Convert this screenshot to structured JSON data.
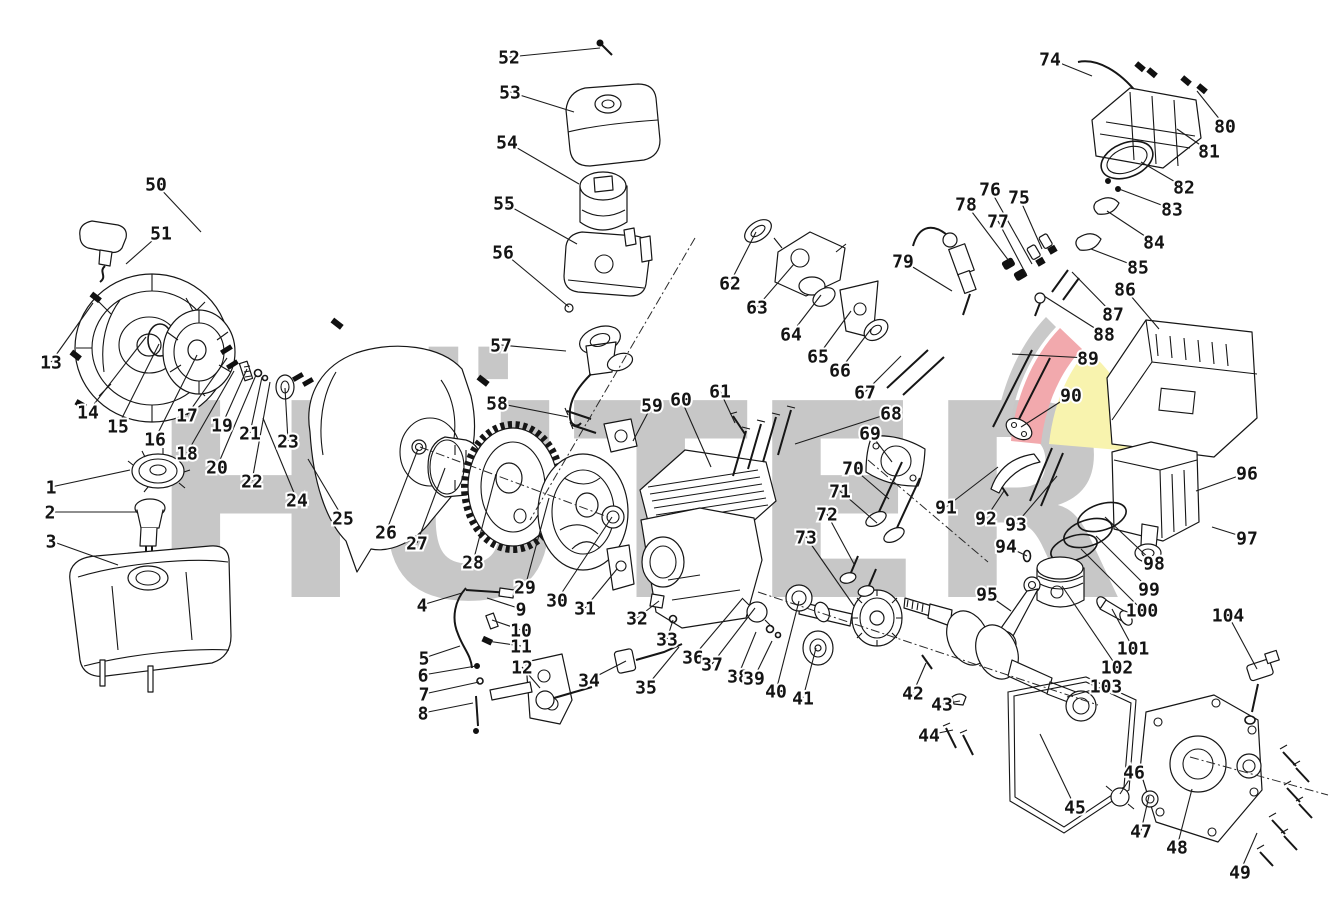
{
  "page": {
    "background_color": "#ffffff",
    "width": 1339,
    "height": 912
  },
  "watermark": {
    "text": "HÜTER",
    "color": "#c7c7c7",
    "logo_gray": "#c9c9c9",
    "logo_red": "#f2a9ad",
    "logo_yellow": "#f8f3ae"
  },
  "diagram": {
    "type": "exploded-parts-diagram",
    "subject": "small gasoline engine",
    "label_format": [
      "number",
      "x",
      "y",
      "target_x",
      "target_y"
    ],
    "labels": [
      [
        1,
        51,
        487,
        130,
        470
      ],
      [
        2,
        50,
        512,
        137,
        512
      ],
      [
        3,
        51,
        541,
        118,
        565
      ],
      [
        4,
        422,
        605,
        462,
        593
      ],
      [
        5,
        424,
        658,
        460,
        646
      ],
      [
        6,
        423,
        675,
        476,
        666
      ],
      [
        7,
        424,
        694,
        479,
        682
      ],
      [
        8,
        423,
        713,
        473,
        703
      ],
      [
        9,
        521,
        609,
        487,
        598
      ],
      [
        10,
        521,
        630,
        492,
        620
      ],
      [
        11,
        521,
        646,
        487,
        641
      ],
      [
        12,
        522,
        667,
        540,
        688
      ],
      [
        13,
        51,
        362,
        93,
        303
      ],
      [
        14,
        88,
        412,
        146,
        337
      ],
      [
        15,
        118,
        426,
        159,
        344
      ],
      [
        16,
        155,
        439,
        197,
        355
      ],
      [
        17,
        187,
        415,
        227,
        358
      ],
      [
        18,
        187,
        453,
        234,
        371
      ],
      [
        19,
        222,
        425,
        247,
        369
      ],
      [
        20,
        217,
        467,
        256,
        375
      ],
      [
        21,
        250,
        433,
        262,
        377
      ],
      [
        22,
        252,
        481,
        270,
        382
      ],
      [
        23,
        288,
        441,
        285,
        388
      ],
      [
        24,
        297,
        500,
        263,
        418
      ],
      [
        25,
        343,
        518,
        308,
        459
      ],
      [
        26,
        386,
        532,
        418,
        449
      ],
      [
        27,
        417,
        543,
        445,
        468
      ],
      [
        28,
        473,
        562,
        496,
        474
      ],
      [
        29,
        525,
        587,
        549,
        498
      ],
      [
        30,
        557,
        600,
        612,
        517
      ],
      [
        31,
        585,
        608,
        617,
        569
      ],
      [
        32,
        637,
        618,
        659,
        601
      ],
      [
        33,
        667,
        639,
        673,
        620
      ],
      [
        34,
        589,
        680,
        626,
        661
      ],
      [
        35,
        646,
        687,
        679,
        647
      ],
      [
        36,
        693,
        657,
        742,
        599
      ],
      [
        37,
        712,
        664,
        755,
        608
      ],
      [
        38,
        738,
        676,
        756,
        632
      ],
      [
        39,
        754,
        678,
        772,
        641
      ],
      [
        40,
        776,
        691,
        799,
        601
      ],
      [
        41,
        803,
        698,
        816,
        648
      ],
      [
        42,
        913,
        693,
        926,
        663
      ],
      [
        43,
        942,
        704,
        960,
        701
      ],
      [
        44,
        929,
        735,
        953,
        730
      ],
      [
        45,
        1075,
        807,
        1040,
        734
      ],
      [
        46,
        1134,
        772,
        1120,
        794
      ],
      [
        47,
        1141,
        831,
        1149,
        796
      ],
      [
        48,
        1177,
        847,
        1192,
        789
      ],
      [
        49,
        1240,
        872,
        1257,
        833
      ],
      [
        50,
        156,
        184,
        201,
        232
      ],
      [
        51,
        161,
        233,
        126,
        264
      ],
      [
        52,
        509,
        57,
        600,
        48
      ],
      [
        53,
        510,
        92,
        574,
        112
      ],
      [
        54,
        507,
        142,
        579,
        184
      ],
      [
        55,
        504,
        203,
        577,
        244
      ],
      [
        56,
        503,
        252,
        569,
        307
      ],
      [
        57,
        501,
        345,
        566,
        351
      ],
      [
        58,
        497,
        403,
        568,
        417
      ],
      [
        59,
        652,
        405,
        633,
        441
      ],
      [
        60,
        681,
        399,
        711,
        467
      ],
      [
        61,
        720,
        391,
        735,
        423
      ],
      [
        62,
        730,
        283,
        756,
        232
      ],
      [
        63,
        757,
        307,
        794,
        264
      ],
      [
        64,
        791,
        334,
        821,
        295
      ],
      [
        65,
        818,
        356,
        851,
        311
      ],
      [
        66,
        840,
        370,
        871,
        329
      ],
      [
        67,
        865,
        392,
        901,
        356
      ],
      [
        68,
        891,
        413,
        795,
        444
      ],
      [
        69,
        870,
        433,
        892,
        462
      ],
      [
        70,
        853,
        468,
        889,
        499
      ],
      [
        71,
        840,
        491,
        877,
        523
      ],
      [
        72,
        827,
        514,
        854,
        564
      ],
      [
        73,
        806,
        537,
        854,
        606
      ],
      [
        74,
        1050,
        59,
        1092,
        76
      ],
      [
        75,
        1019,
        197,
        1042,
        249
      ],
      [
        76,
        990,
        189,
        1032,
        264
      ],
      [
        77,
        998,
        221,
        1027,
        276
      ],
      [
        78,
        966,
        204,
        1009,
        261
      ],
      [
        79,
        903,
        261,
        952,
        291
      ],
      [
        80,
        1225,
        126,
        1197,
        91
      ],
      [
        81,
        1209,
        151,
        1177,
        129
      ],
      [
        82,
        1184,
        187,
        1141,
        162
      ],
      [
        83,
        1172,
        209,
        1119,
        189
      ],
      [
        84,
        1154,
        242,
        1107,
        211
      ],
      [
        85,
        1138,
        267,
        1091,
        249
      ],
      [
        86,
        1125,
        289,
        1159,
        329
      ],
      [
        87,
        1113,
        314,
        1072,
        272
      ],
      [
        88,
        1104,
        334,
        1044,
        296
      ],
      [
        89,
        1088,
        358,
        1012,
        354
      ],
      [
        90,
        1071,
        395,
        1021,
        427
      ],
      [
        91,
        946,
        507,
        998,
        467
      ],
      [
        92,
        986,
        518,
        1004,
        491
      ],
      [
        93,
        1016,
        524,
        1057,
        476
      ],
      [
        94,
        1006,
        546,
        1027,
        556
      ],
      [
        95,
        987,
        594,
        1011,
        611
      ],
      [
        96,
        1247,
        473,
        1196,
        491
      ],
      [
        97,
        1247,
        538,
        1212,
        527
      ],
      [
        98,
        1154,
        563,
        1105,
        517
      ],
      [
        99,
        1149,
        589,
        1096,
        536
      ],
      [
        100,
        1142,
        610,
        1081,
        549
      ],
      [
        101,
        1133,
        648,
        1112,
        609
      ],
      [
        102,
        1117,
        667,
        1062,
        586
      ],
      [
        103,
        1106,
        686,
        1067,
        697
      ],
      [
        104,
        1228,
        615,
        1257,
        669
      ]
    ]
  }
}
